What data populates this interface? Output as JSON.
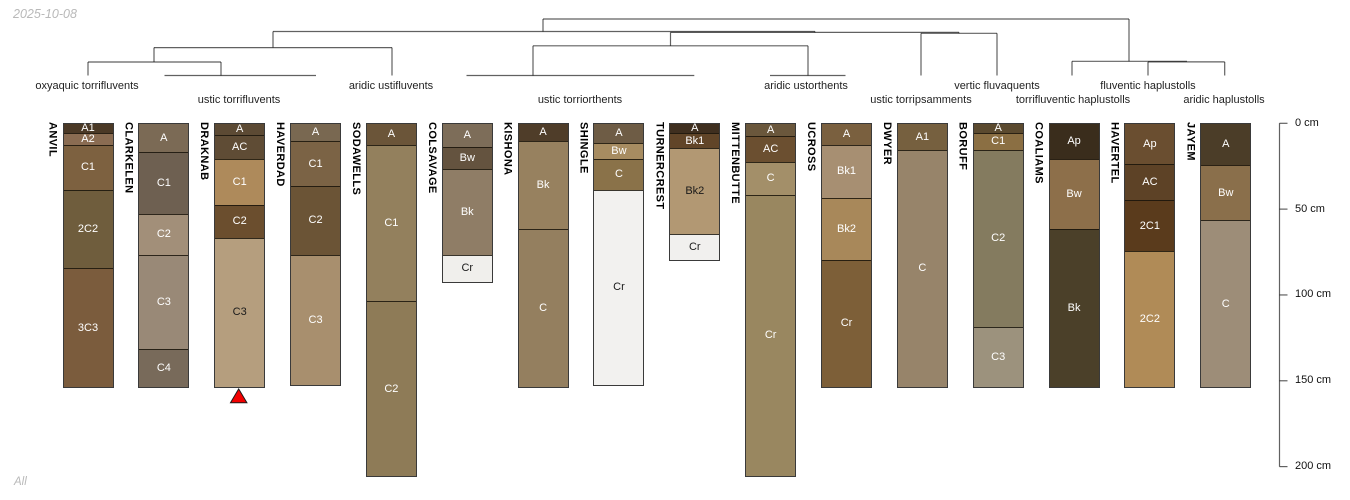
{
  "page": {
    "date_label": "2025-10-08",
    "footer_label": "All"
  },
  "chart_data": {
    "type": "bar",
    "title": "",
    "description": "Sixteen soil profile sketches (depth in cm) arranged beneath a dendrogram of subgroup taxa; red triangle marks DRAKNAB",
    "depth_axis": {
      "unit": "cm",
      "min": 0,
      "max": 200,
      "grid": false,
      "ticks": [
        {
          "cm": 0,
          "label": "0 cm"
        },
        {
          "cm": 50,
          "label": "50 cm"
        },
        {
          "cm": 100,
          "label": "100 cm"
        },
        {
          "cm": 150,
          "label": "150 cm"
        },
        {
          "cm": 200,
          "label": "200 cm"
        }
      ]
    },
    "groups": [
      {
        "label": "oxyaquic torrifluvents",
        "x": 87,
        "row": 1
      },
      {
        "label": "ustic torrifluvents",
        "x": 239,
        "row": 2
      },
      {
        "label": "aridic ustifluvents",
        "x": 391,
        "row": 1
      },
      {
        "label": "ustic torriorthents",
        "x": 580,
        "row": 2
      },
      {
        "label": "aridic ustorthents",
        "x": 806,
        "row": 1
      },
      {
        "label": "ustic torripsamments",
        "x": 921,
        "row": 2
      },
      {
        "label": "vertic fluvaquents",
        "x": 997,
        "row": 1
      },
      {
        "label": "torrifluventic haplustolls",
        "x": 1073,
        "row": 2
      },
      {
        "label": "fluventic haplustolls",
        "x": 1148,
        "row": 1
      },
      {
        "label": "aridic haplustolls",
        "x": 1224,
        "row": 2
      }
    ],
    "dendrogram": {
      "stroke": "#000000",
      "h_segments": [
        [
          19,
          543,
          1129
        ],
        [
          31.5,
          273,
          815
        ],
        [
          32.4,
          670.5,
          959
        ],
        [
          33.3,
          921,
          997
        ],
        [
          45.8,
          533,
          808
        ],
        [
          47.6,
          154,
          392
        ],
        [
          62,
          88,
          221
        ],
        [
          61.3,
          1072,
          1187
        ],
        [
          61.9,
          1148,
          1224.7
        ],
        [
          75.5,
          164.5,
          316
        ],
        [
          75.5,
          466.5,
          694.3
        ],
        [
          75.5,
          770,
          845.5
        ]
      ],
      "v_segments": [
        [
          543,
          19,
          31.5
        ],
        [
          1129,
          19,
          61.3
        ],
        [
          273,
          31.5,
          47.6
        ],
        [
          815,
          31.5,
          32.4
        ],
        [
          670.5,
          32.4,
          45.8
        ],
        [
          959,
          32.4,
          33.3
        ],
        [
          921,
          33.3,
          75.5
        ],
        [
          997,
          33.3,
          75.5
        ],
        [
          154,
          47.6,
          62
        ],
        [
          392,
          47.6,
          75.5
        ],
        [
          88,
          62,
          75.5
        ],
        [
          221,
          62,
          75.5
        ],
        [
          533,
          45.8,
          75.5
        ],
        [
          808,
          45.8,
          75.5
        ],
        [
          1072,
          61.3,
          75.5
        ],
        [
          1148,
          61.9,
          75.5
        ],
        [
          1224.7,
          61.9,
          75.5
        ]
      ]
    },
    "marker": {
      "shape": "triangle-up",
      "color": "#f20000",
      "profile": "DRAKNAB"
    },
    "profiles": [
      {
        "name": "ANVIL",
        "taxon": "oxyaquic torrifluvents",
        "horizons": [
          {
            "label": "A1",
            "top_cm": 0,
            "bottom_cm": 5,
            "color": "#4b3926",
            "text_color": "#ffffff"
          },
          {
            "label": "A2",
            "top_cm": 5,
            "bottom_cm": 12,
            "color": "#8a6c52",
            "text_color": "#ffffff"
          },
          {
            "label": "C1",
            "top_cm": 12,
            "bottom_cm": 38,
            "color": "#7d6140",
            "text_color": "#ffffff"
          },
          {
            "label": "2C2",
            "top_cm": 38,
            "bottom_cm": 84,
            "color": "#6f5d3d",
            "text_color": "#ffffff"
          },
          {
            "label": "3C3",
            "top_cm": 84,
            "bottom_cm": 153,
            "color": "#7b5c3d",
            "text_color": "#ffffff"
          }
        ]
      },
      {
        "name": "CLARKELEN",
        "taxon": "ustic torrifluvents",
        "horizons": [
          {
            "label": "A",
            "top_cm": 0,
            "bottom_cm": 16,
            "color": "#7b6a55",
            "text_color": "#ffffff"
          },
          {
            "label": "C1",
            "top_cm": 16,
            "bottom_cm": 52,
            "color": "#6e6051",
            "text_color": "#ffffff"
          },
          {
            "label": "C2",
            "top_cm": 52,
            "bottom_cm": 76,
            "color": "#a28f79",
            "text_color": "#ffffff"
          },
          {
            "label": "C3",
            "top_cm": 76,
            "bottom_cm": 131,
            "color": "#998977",
            "text_color": "#ffffff"
          },
          {
            "label": "C4",
            "top_cm": 131,
            "bottom_cm": 153,
            "color": "#786a5a",
            "text_color": "#ffffff"
          }
        ]
      },
      {
        "name": "DRAKNAB",
        "taxon": "ustic torrifluvents",
        "horizons": [
          {
            "label": "A",
            "top_cm": 0,
            "bottom_cm": 6,
            "color": "#5c4a34",
            "text_color": "#ffffff"
          },
          {
            "label": "AC",
            "top_cm": 6,
            "bottom_cm": 20,
            "color": "#5f4c35",
            "text_color": "#ffffff"
          },
          {
            "label": "C1",
            "top_cm": 20,
            "bottom_cm": 47,
            "color": "#ae8a5b",
            "text_color": "#ffffff"
          },
          {
            "label": "C2",
            "top_cm": 47,
            "bottom_cm": 66,
            "color": "#6b4e2e",
            "text_color": "#ffffff"
          },
          {
            "label": "C3",
            "top_cm": 66,
            "bottom_cm": 153,
            "color": "#b59e7e",
            "text_color": "#1a1a1a"
          }
        ]
      },
      {
        "name": "HAVERDAD",
        "taxon": "ustic torrifluvents",
        "horizons": [
          {
            "label": "A",
            "top_cm": 0,
            "bottom_cm": 10,
            "color": "#796851",
            "text_color": "#ffffff"
          },
          {
            "label": "C1",
            "top_cm": 10,
            "bottom_cm": 36,
            "color": "#7b6345",
            "text_color": "#ffffff"
          },
          {
            "label": "C2",
            "top_cm": 36,
            "bottom_cm": 76,
            "color": "#6b5436",
            "text_color": "#ffffff"
          },
          {
            "label": "C3",
            "top_cm": 76,
            "bottom_cm": 152,
            "color": "#a88f6e",
            "text_color": "#ffffff"
          }
        ]
      },
      {
        "name": "SODAWELLS",
        "taxon": "aridic ustifluvents",
        "horizons": [
          {
            "label": "A",
            "top_cm": 0,
            "bottom_cm": 12,
            "color": "#6b5539",
            "text_color": "#ffffff"
          },
          {
            "label": "C1",
            "top_cm": 12,
            "bottom_cm": 103,
            "color": "#93805d",
            "text_color": "#ffffff"
          },
          {
            "label": "C2",
            "top_cm": 103,
            "bottom_cm": 205,
            "color": "#8e7b57",
            "text_color": "#ffffff"
          }
        ]
      },
      {
        "name": "COLSAVAGE",
        "taxon": "ustic torriorthents",
        "horizons": [
          {
            "label": "A",
            "top_cm": 0,
            "bottom_cm": 13,
            "color": "#7d6d59",
            "text_color": "#ffffff"
          },
          {
            "label": "Bw",
            "top_cm": 13,
            "bottom_cm": 26,
            "color": "#64533f",
            "text_color": "#ffffff"
          },
          {
            "label": "Bk",
            "top_cm": 26,
            "bottom_cm": 76,
            "color": "#8f7d66",
            "text_color": "#ffffff"
          },
          {
            "label": "Cr",
            "top_cm": 76,
            "bottom_cm": 92,
            "color": "#f0efec",
            "text_color": "#1a1a1a"
          }
        ]
      },
      {
        "name": "KISHONA",
        "taxon": "ustic torriorthents",
        "horizons": [
          {
            "label": "A",
            "top_cm": 0,
            "bottom_cm": 10,
            "color": "#4f3d29",
            "text_color": "#ffffff"
          },
          {
            "label": "Bk",
            "top_cm": 10,
            "bottom_cm": 61,
            "color": "#97815f",
            "text_color": "#ffffff"
          },
          {
            "label": "C",
            "top_cm": 61,
            "bottom_cm": 153,
            "color": "#947f5f",
            "text_color": "#ffffff"
          }
        ]
      },
      {
        "name": "SHINGLE",
        "taxon": "ustic torriorthents",
        "horizons": [
          {
            "label": "A",
            "top_cm": 0,
            "bottom_cm": 11,
            "color": "#6e5c45",
            "text_color": "#ffffff"
          },
          {
            "label": "Bw",
            "top_cm": 11,
            "bottom_cm": 20,
            "color": "#a78c61",
            "text_color": "#ffffff"
          },
          {
            "label": "C",
            "top_cm": 20,
            "bottom_cm": 38,
            "color": "#8a7249",
            "text_color": "#ffffff"
          },
          {
            "label": "Cr",
            "top_cm": 38,
            "bottom_cm": 152,
            "color": "#f2f1ef",
            "text_color": "#1a1a1a"
          }
        ]
      },
      {
        "name": "TURNERCREST",
        "taxon": "ustic torriorthents",
        "horizons": [
          {
            "label": "A",
            "top_cm": 0,
            "bottom_cm": 5,
            "color": "#3f2f1f",
            "text_color": "#ffffff"
          },
          {
            "label": "Bk1",
            "top_cm": 5,
            "bottom_cm": 14,
            "color": "#614528",
            "text_color": "#ffffff"
          },
          {
            "label": "Bk2",
            "top_cm": 14,
            "bottom_cm": 64,
            "color": "#b29873",
            "text_color": "#1a1a1a"
          },
          {
            "label": "Cr",
            "top_cm": 64,
            "bottom_cm": 79,
            "color": "#f1f0ee",
            "text_color": "#1a1a1a"
          }
        ]
      },
      {
        "name": "MITTENBUTTE",
        "taxon": "aridic ustorthents",
        "horizons": [
          {
            "label": "A",
            "top_cm": 0,
            "bottom_cm": 7,
            "color": "#6a573c",
            "text_color": "#ffffff"
          },
          {
            "label": "AC",
            "top_cm": 7,
            "bottom_cm": 22,
            "color": "#6b4f30",
            "text_color": "#ffffff"
          },
          {
            "label": "C",
            "top_cm": 22,
            "bottom_cm": 41,
            "color": "#a38f69",
            "text_color": "#ffffff"
          },
          {
            "label": "Cr",
            "top_cm": 41,
            "bottom_cm": 205,
            "color": "#998760",
            "text_color": "#ffffff"
          }
        ]
      },
      {
        "name": "UCROSS",
        "taxon": "aridic ustorthents",
        "horizons": [
          {
            "label": "A",
            "top_cm": 0,
            "bottom_cm": 12,
            "color": "#7a603f",
            "text_color": "#ffffff"
          },
          {
            "label": "Bk1",
            "top_cm": 12,
            "bottom_cm": 43,
            "color": "#a78f72",
            "text_color": "#ffffff"
          },
          {
            "label": "Bk2",
            "top_cm": 43,
            "bottom_cm": 79,
            "color": "#a8885a",
            "text_color": "#ffffff"
          },
          {
            "label": "Cr",
            "top_cm": 79,
            "bottom_cm": 153,
            "color": "#7d5f38",
            "text_color": "#ffffff"
          }
        ]
      },
      {
        "name": "DWYER",
        "taxon": "ustic torripsamments",
        "horizons": [
          {
            "label": "A1",
            "top_cm": 0,
            "bottom_cm": 15,
            "color": "#76603f",
            "text_color": "#ffffff"
          },
          {
            "label": "C",
            "top_cm": 15,
            "bottom_cm": 153,
            "color": "#97846a",
            "text_color": "#ffffff"
          }
        ]
      },
      {
        "name": "BORUFF",
        "taxon": "vertic fluvaquents",
        "horizons": [
          {
            "label": "A",
            "top_cm": 0,
            "bottom_cm": 5,
            "color": "#5b4a2f",
            "text_color": "#ffffff"
          },
          {
            "label": "C1",
            "top_cm": 5,
            "bottom_cm": 15,
            "color": "#8b6f43",
            "text_color": "#ffffff"
          },
          {
            "label": "C2",
            "top_cm": 15,
            "bottom_cm": 118,
            "color": "#847b5f",
            "text_color": "#ffffff"
          },
          {
            "label": "C3",
            "top_cm": 118,
            "bottom_cm": 153,
            "color": "#9c927d",
            "text_color": "#ffffff"
          }
        ]
      },
      {
        "name": "COALIAMS",
        "taxon": "torrifluventic haplustolls",
        "horizons": [
          {
            "label": "Ap",
            "top_cm": 0,
            "bottom_cm": 20,
            "color": "#3a2d1c",
            "text_color": "#ffffff"
          },
          {
            "label": "Bw",
            "top_cm": 20,
            "bottom_cm": 61,
            "color": "#8d6f4a",
            "text_color": "#ffffff"
          },
          {
            "label": "Bk",
            "top_cm": 61,
            "bottom_cm": 153,
            "color": "#4b4029",
            "text_color": "#ffffff"
          }
        ]
      },
      {
        "name": "HAVERTEL",
        "taxon": "fluventic haplustolls",
        "horizons": [
          {
            "label": "Ap",
            "top_cm": 0,
            "bottom_cm": 23,
            "color": "#6a4e30",
            "text_color": "#ffffff"
          },
          {
            "label": "AC",
            "top_cm": 23,
            "bottom_cm": 44,
            "color": "#5d4226",
            "text_color": "#ffffff"
          },
          {
            "label": "2C1",
            "top_cm": 44,
            "bottom_cm": 74,
            "color": "#5a3b1c",
            "text_color": "#ffffff"
          },
          {
            "label": "2C2",
            "top_cm": 74,
            "bottom_cm": 153,
            "color": "#b08b57",
            "text_color": "#ffffff"
          }
        ]
      },
      {
        "name": "JAYEM",
        "taxon": "aridic haplustolls",
        "horizons": [
          {
            "label": "A",
            "top_cm": 0,
            "bottom_cm": 24,
            "color": "#4b3d28",
            "text_color": "#ffffff"
          },
          {
            "label": "Bw",
            "top_cm": 24,
            "bottom_cm": 56,
            "color": "#8a6f4b",
            "text_color": "#ffffff"
          },
          {
            "label": "C",
            "top_cm": 56,
            "bottom_cm": 153,
            "color": "#9d8d78",
            "text_color": "#ffffff"
          }
        ]
      }
    ],
    "layout": {
      "x_first_center": 87,
      "x_spacing": 75.85,
      "column_width": 49,
      "depth0_y": 123.3,
      "px_per_cm": 1.7165,
      "axis_x": 1279.5,
      "group_row1_top": 80,
      "group_row2_top": 94
    }
  }
}
